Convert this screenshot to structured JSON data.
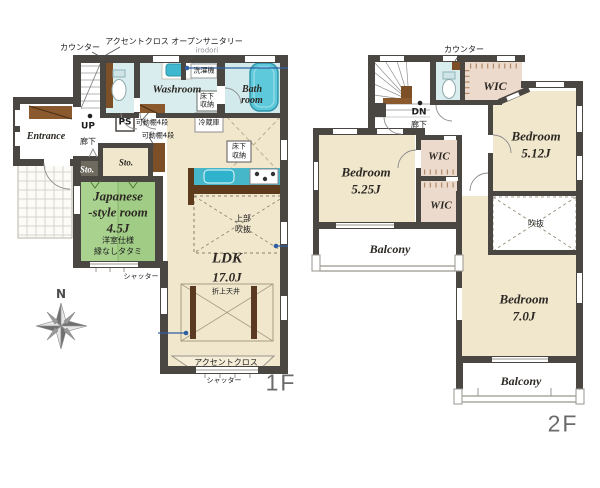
{
  "colors": {
    "wall": "#4a4642",
    "floor_beige": "#f1e7cd",
    "tatami_green": "#a8d28e",
    "water_blue": "#d9edef",
    "bathtub": "#5ec9da",
    "kitchen_counter": "#45b7c9",
    "wood_brown": "#7c4f27",
    "closet_pink": "#ecdacc",
    "annotation_blue": "#2e5fa3"
  },
  "compass": {
    "label": "N"
  },
  "floor1": {
    "floor_label": "1F",
    "rooms": {
      "entrance": "Entrance",
      "washroom": "Washroom",
      "bath_line1": "Bath",
      "bath_line2": "room",
      "sto_small": "Sto.",
      "sto_large": "Sto.",
      "japanese_line1": "Japanese",
      "japanese_line2": "-style room",
      "japanese_line3": "4.5J",
      "japanese_note1": "洋室仕様",
      "japanese_note2": "縁なしタタミ",
      "ldk_line1": "LDK",
      "ldk_line2": "17.0J"
    },
    "annotations": {
      "counter": "カウンター",
      "accent_cloth_top": "アクセントクロス",
      "open_sanitary": "オープンサニタリー",
      "open_sanitary_name": "irodori",
      "washing_machine": "洗濯機",
      "underfloor_wash_1": "床下",
      "underfloor_wash_2": "収納",
      "up": "UP",
      "ps": "PS",
      "corridor": "廊下",
      "shelf_1": "可動棚4段",
      "shelf_2": "可動棚4段",
      "refrigerator": "冷蔵庫",
      "underfloor_kitchen_1": "床下",
      "underfloor_kitchen_2": "収納",
      "upper_void_1": "上部",
      "upper_void_2": "吹抜",
      "coffered_ceiling": "折上天井",
      "accent_cloth_bottom": "アクセントクロス",
      "shutter_south": "シャッター",
      "shutter_ldk": "シャッター"
    }
  },
  "floor2": {
    "floor_label": "2F",
    "rooms": {
      "wic_top": "WIC",
      "wic_mid": "WIC",
      "wic_low": "WIC",
      "bedroom_512_line1": "Bedroom",
      "bedroom_512_line2": "5.12J",
      "bedroom_525_line1": "Bedroom",
      "bedroom_525_line2": "5.25J",
      "bedroom_70_line1": "Bedroom",
      "bedroom_70_line2": "7.0J",
      "void": "吹抜",
      "balcony_west": "Balcony",
      "balcony_south": "Balcony"
    },
    "annotations": {
      "counter": "カウンター",
      "dn": "DN",
      "corridor": "廊下"
    }
  }
}
